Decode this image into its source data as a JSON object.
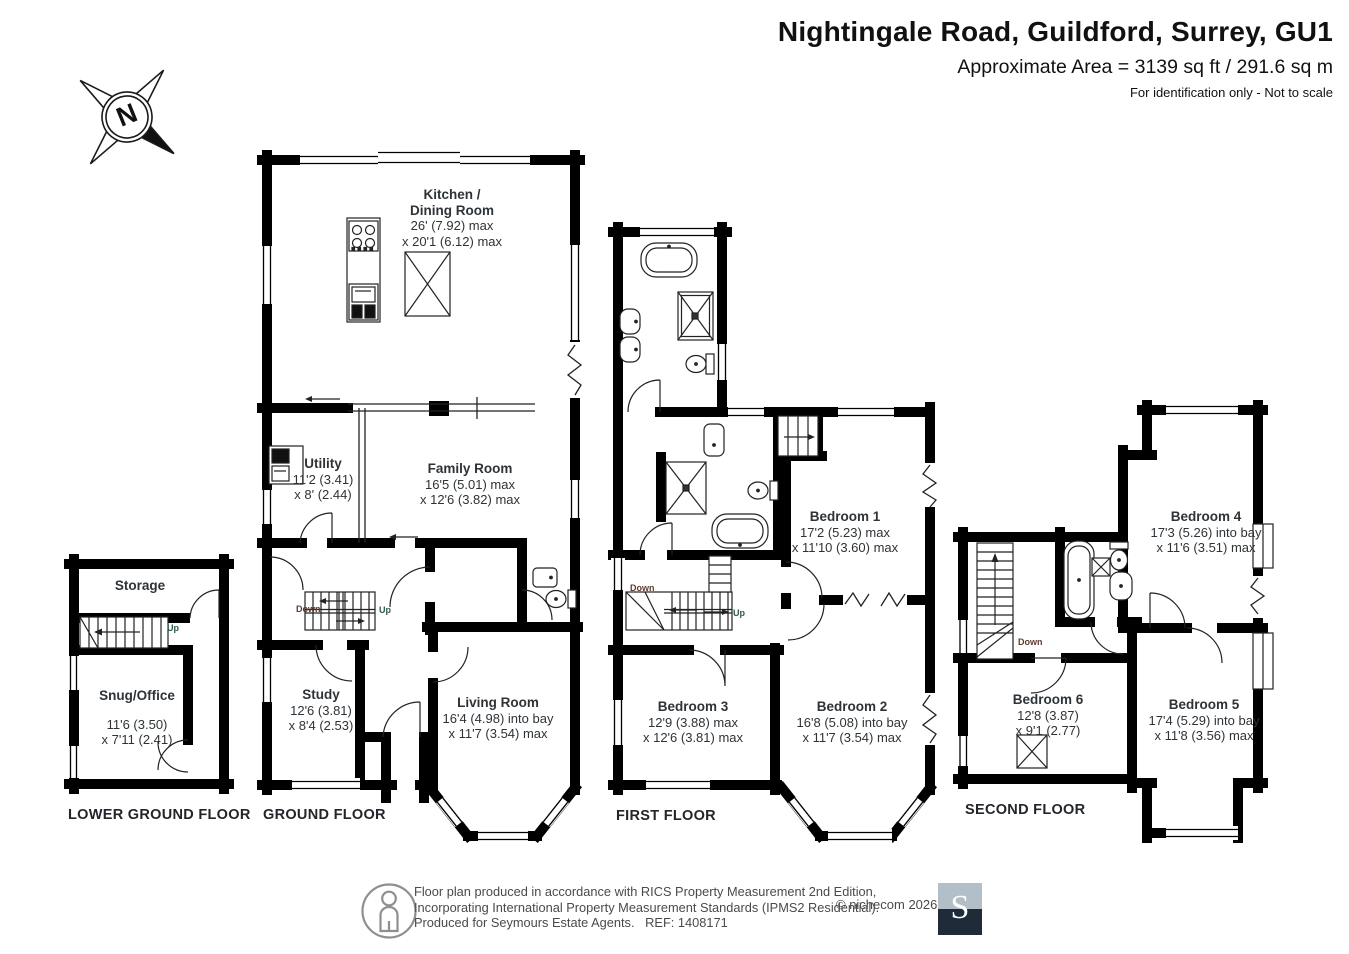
{
  "header": {
    "title": "Nightingale Road, Guildford, Surrey, GU1",
    "area_line": "Approximate Area = 3139 sq ft / 291.6 sq m",
    "note": "For identification only - Not to scale"
  },
  "compass": {
    "letter": "N"
  },
  "floors": {
    "lower_ground": {
      "label": "LOWER GROUND FLOOR",
      "rooms": {
        "storage": {
          "name": "Storage"
        },
        "snug": {
          "name": "Snug/Office",
          "dim1": "11'6 (3.50)",
          "dim2": "x 7'11 (2.41)"
        }
      },
      "stairs": {
        "up": "Up"
      }
    },
    "ground": {
      "label": "GROUND FLOOR",
      "rooms": {
        "kitchen": {
          "name": "Kitchen /",
          "name2": "Dining Room",
          "dim1": "26' (7.92) max",
          "dim2": "x 20'1 (6.12) max"
        },
        "utility": {
          "name": "Utility",
          "dim1": "11'2 (3.41)",
          "dim2": "x 8' (2.44)"
        },
        "family": {
          "name": "Family Room",
          "dim1": "16'5 (5.01) max",
          "dim2": "x 12'6 (3.82) max"
        },
        "study": {
          "name": "Study",
          "dim1": "12'6 (3.81)",
          "dim2": "x 8'4 (2.53)"
        },
        "living": {
          "name": "Living Room",
          "dim1": "16'4 (4.98) into bay",
          "dim2": "x 11'7 (3.54) max"
        }
      },
      "stairs": {
        "down": "Down",
        "up": "Up"
      }
    },
    "first": {
      "label": "FIRST FLOOR",
      "rooms": {
        "bedroom1": {
          "name": "Bedroom 1",
          "dim1": "17'2 (5.23) max",
          "dim2": "x 11'10 (3.60) max"
        },
        "bedroom2": {
          "name": "Bedroom 2",
          "dim1": "16'8 (5.08) into bay",
          "dim2": "x 11'7 (3.54) max"
        },
        "bedroom3": {
          "name": "Bedroom 3",
          "dim1": "12'9 (3.88) max",
          "dim2": "x 12'6 (3.81) max"
        }
      },
      "stairs": {
        "down": "Down",
        "up": "Up"
      }
    },
    "second": {
      "label": "SECOND FLOOR",
      "rooms": {
        "bedroom4": {
          "name": "Bedroom 4",
          "dim1": "17'3 (5.26) into bay",
          "dim2": "x 11'6 (3.51) max"
        },
        "bedroom5": {
          "name": "Bedroom 5",
          "dim1": "17'4 (5.29) into bay",
          "dim2": "x 11'8 (3.56) max"
        },
        "bedroom6": {
          "name": "Bedroom 6",
          "dim1": "12'8 (3.87)",
          "dim2": "x 9'1 (2.77)"
        }
      },
      "stairs": {
        "down": "Down"
      }
    }
  },
  "footer": {
    "line1": "Floor plan produced in accordance with RICS Property Measurement 2nd Edition,",
    "line2": "Incorporating International Property Measurement Standards (IPMS2 Residential).",
    "line3": "Produced for Seymours Estate Agents.   REF: 1408171",
    "copyright": "© nichecom 2026.",
    "logo_letter": "S"
  }
}
